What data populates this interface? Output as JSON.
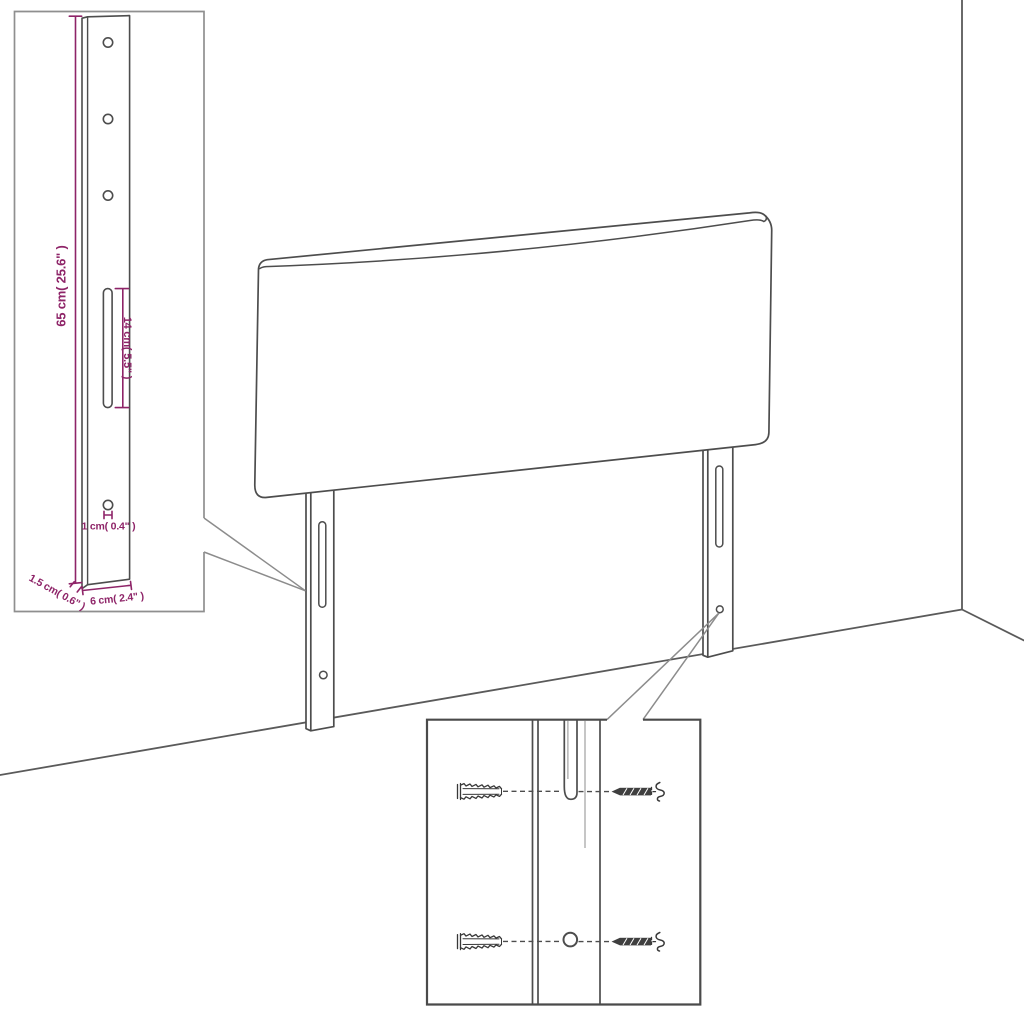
{
  "diagram_title": "headboard-assembly-dimension-diagram",
  "dimensions": {
    "height": {
      "cm": "65",
      "inches": "25.6",
      "label": "65 cm( 25.6\" )"
    },
    "slot_length": {
      "cm": "14",
      "inches": "5.5",
      "label": "14 cm( 5.5\" )"
    },
    "hole": {
      "cm": "1",
      "inches": "0.4",
      "label": "1 cm( 0.4\" )"
    },
    "thickness": {
      "cm": "1.5",
      "inches": "0.6",
      "label": "1.5 cm( 0.6\" )"
    },
    "leg_width": {
      "cm": "6",
      "inches": "2.4",
      "label": "6 cm( 2.4\" )"
    }
  },
  "colors": {
    "dimension_annotation": "#8e2468",
    "line_art": "#4d4d4d",
    "leader_lines": "#8c8c8c",
    "inset_border_left": "#8f8f8f",
    "inset_border_bottom": "#4a4a4a",
    "background": "#ffffff"
  },
  "icons": {
    "wall_plug": "wall-plug-icon",
    "screw": "screw-icon"
  }
}
